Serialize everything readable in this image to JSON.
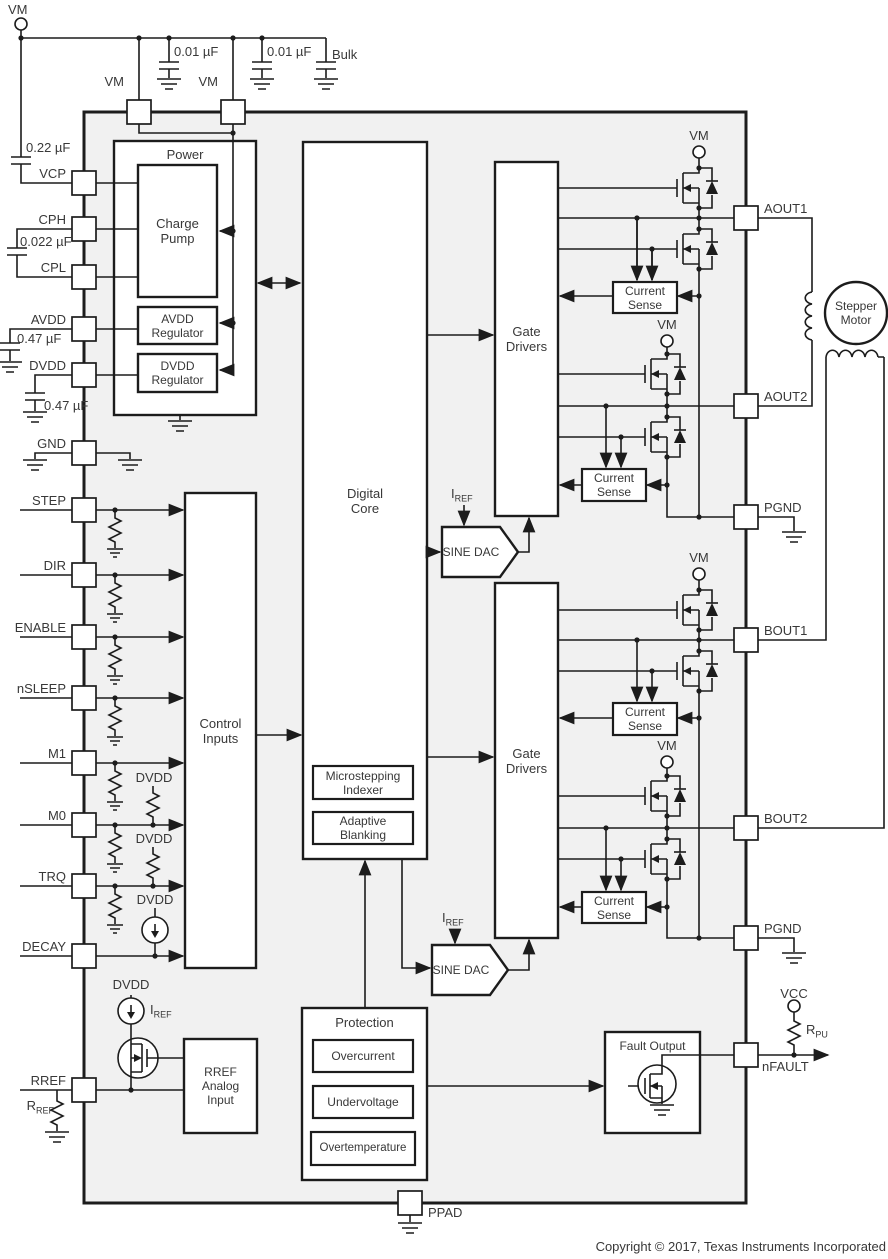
{
  "diagram": {
    "top_rail": {
      "vm_terminal": "VM",
      "cap1": "0.01 µF",
      "cap2": "0.01 µF",
      "bulk": "Bulk"
    },
    "top_pins": {
      "vm1": "VM",
      "vm2": "VM"
    },
    "left_pins": {
      "vcp": {
        "label": "VCP",
        "cap": "0.22 µF"
      },
      "cph": {
        "label": "CPH",
        "cap": "0.022 µF"
      },
      "cpl": {
        "label": "CPL"
      },
      "avdd": {
        "label": "AVDD",
        "cap": "0.47 µF"
      },
      "dvdd": {
        "label": "DVDD",
        "cap": "0.47 µF"
      },
      "gnd": {
        "label": "GND"
      },
      "step": {
        "label": "STEP"
      },
      "dir": {
        "label": "DIR"
      },
      "enable": {
        "label": "ENABLE"
      },
      "nsleep": {
        "label": "nSLEEP"
      },
      "m1": {
        "label": "M1"
      },
      "m0": {
        "label": "M0",
        "pullup": "DVDD"
      },
      "trq": {
        "label": "TRQ",
        "pullup": "DVDD"
      },
      "decay": {
        "label": "DECAY",
        "pullup": "DVDD"
      },
      "rref": {
        "label": "RREF",
        "resistor": {
          "base": "R",
          "sub": "REF"
        }
      }
    },
    "right_pins": {
      "aout1": "AOUT1",
      "aout2": "AOUT2",
      "pgnd1": "PGND",
      "bout1": "BOUT1",
      "bout2": "BOUT2",
      "pgnd2": "PGND",
      "nfault": "nFAULT"
    },
    "bottom_pin": {
      "ppad": "PPAD"
    },
    "blocks": {
      "power": "Power",
      "charge_pump": "Charge\nPump",
      "avdd_reg": "AVDD\nRegulator",
      "dvdd_reg": "DVDD\nRegulator",
      "control_inputs": "Control\nInputs",
      "digital_core": "Digital\nCore",
      "microstepping": "Microstepping\nIndexer",
      "adaptive_blanking": "Adaptive\nBlanking",
      "gate_drivers": "Gate\nDrivers",
      "current_sense": "Current\nSense",
      "sine_dac": "SINE DAC",
      "protection": "Protection",
      "overcurrent": "Overcurrent",
      "undervoltage": "Undervoltage",
      "overtemperature": "Overtemperature",
      "rref_analog_input": "RREF\nAnalog\nInput",
      "fault_output": "Fault Output",
      "stepper_motor": "Stepper\nMotor"
    },
    "nets": {
      "vm": "VM",
      "dvdd": "DVDD",
      "vcc": "VCC",
      "iref": {
        "base": "I",
        "sub": "REF"
      },
      "rpu": {
        "base": "R",
        "sub": "PU"
      }
    },
    "footer": {
      "copyright": "Copyright © 2017, Texas Instruments Incorporated"
    },
    "colors": {
      "line": "#1c1c1c",
      "text": "#383838",
      "chip_fill": "#f1f1f1",
      "block_fill": "#ffffff"
    }
  }
}
